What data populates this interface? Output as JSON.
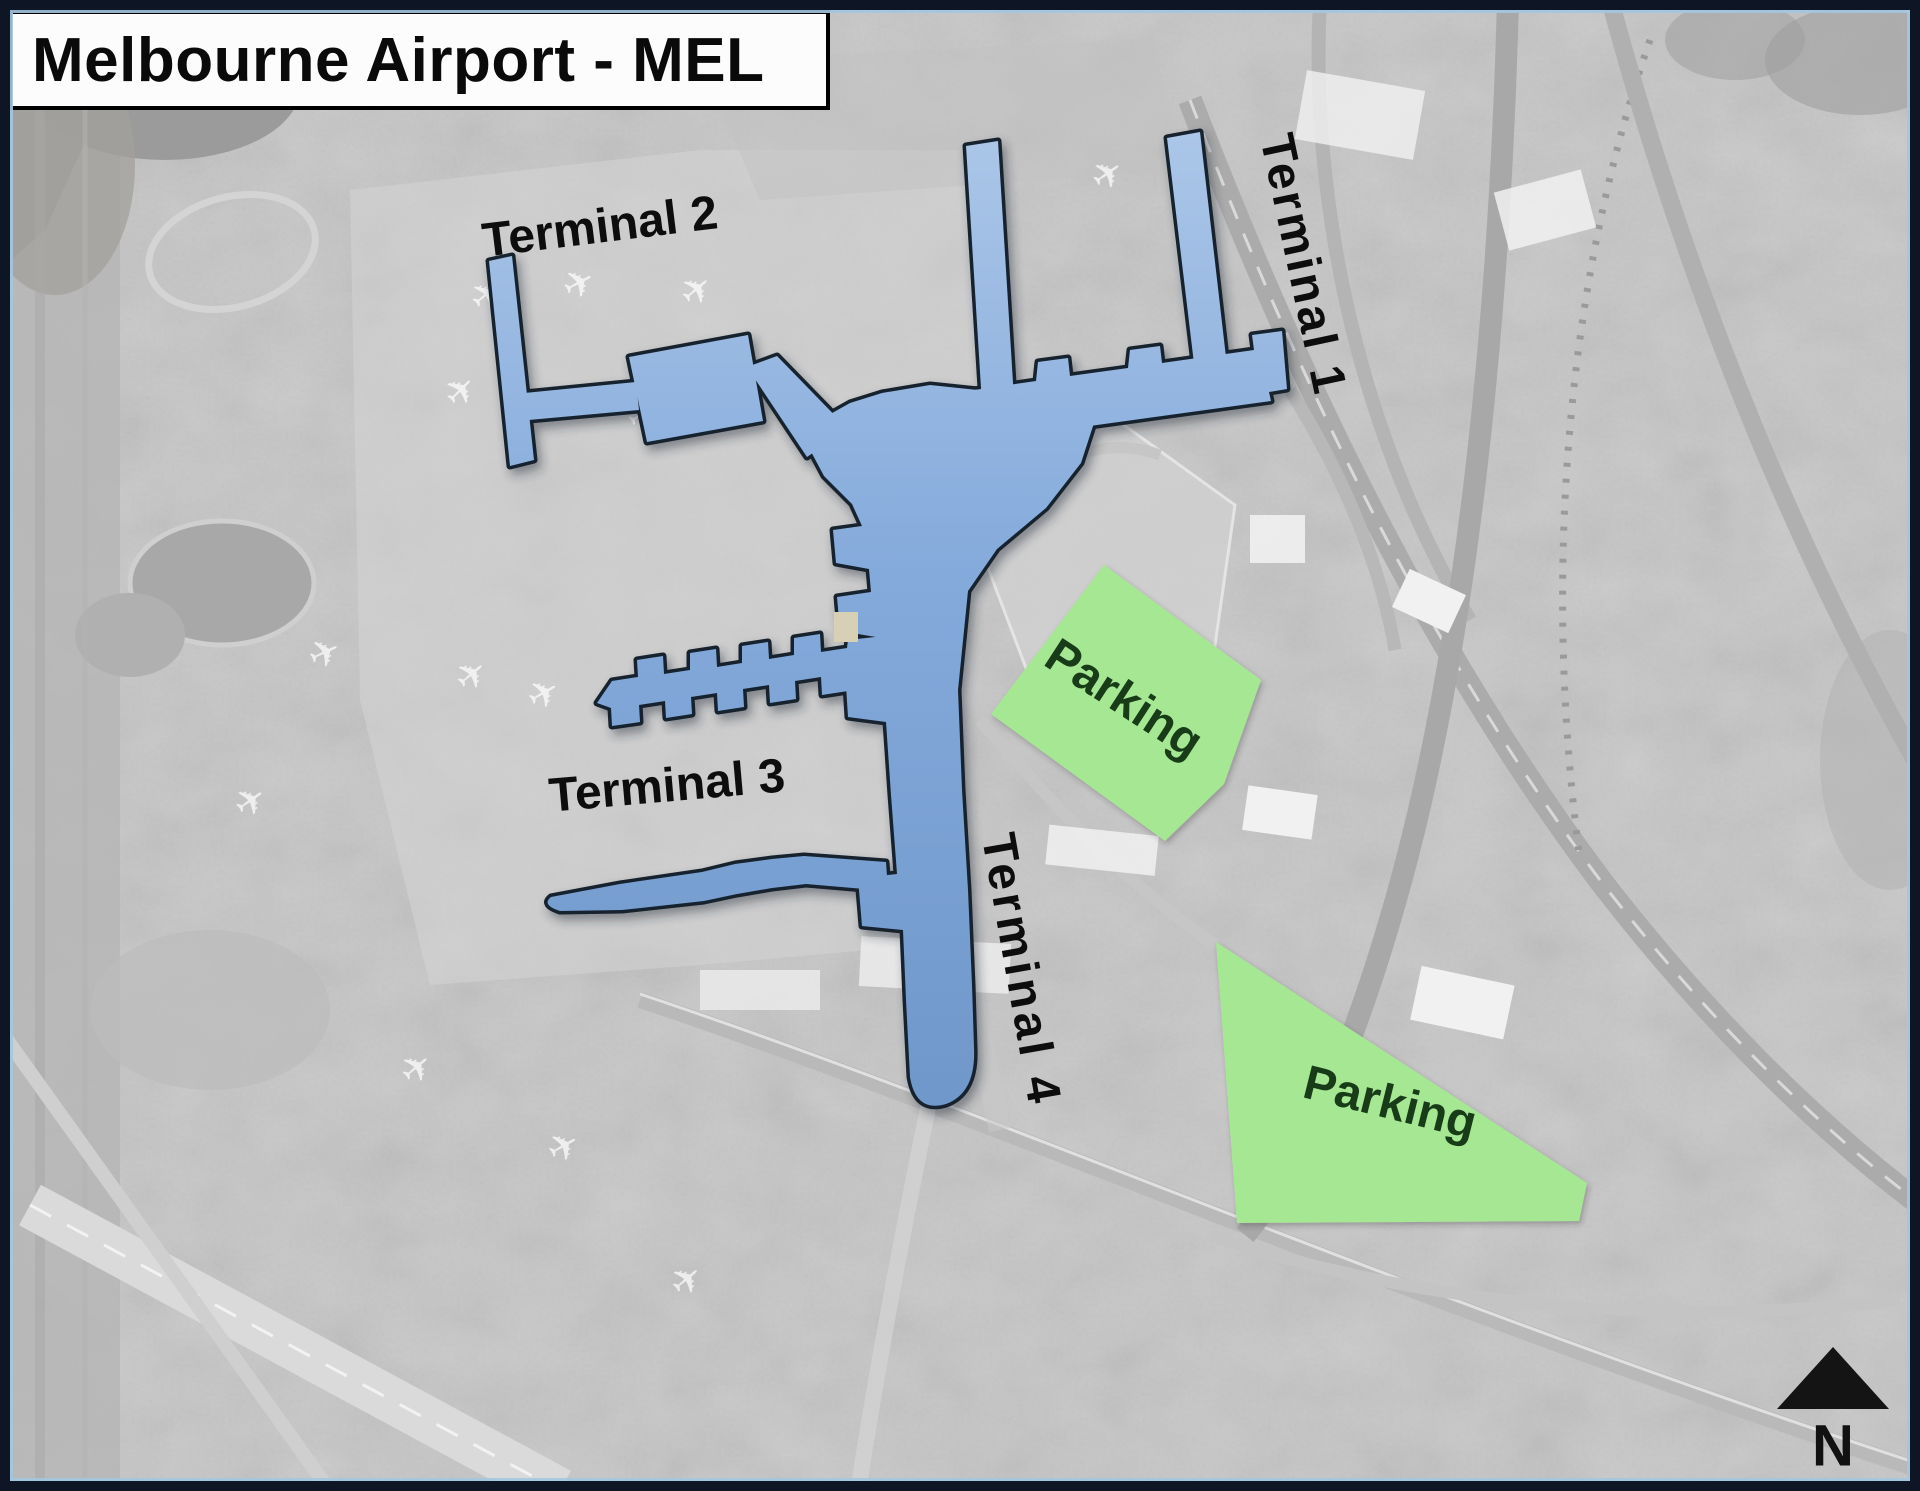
{
  "title": "Melbourne Airport - MEL",
  "labels": {
    "terminal1": "Terminal 1",
    "terminal2": "Terminal 2",
    "terminal3": "Terminal 3",
    "terminal4": "Terminal 4",
    "parking_north": "Parking",
    "parking_south": "Parking",
    "north_indicator": "N"
  },
  "colors": {
    "terminal_fill": "#84aadb",
    "terminal_outline": "#17202e",
    "parking_fill": "#a6e794",
    "parking_text": "#173c17",
    "label_text": "#0d0d0d",
    "title_bg": "#fcfcfc",
    "title_border": "#000000",
    "title_text": "#0a0a0a",
    "north_color": "#111111",
    "frame": "#0e1524"
  }
}
